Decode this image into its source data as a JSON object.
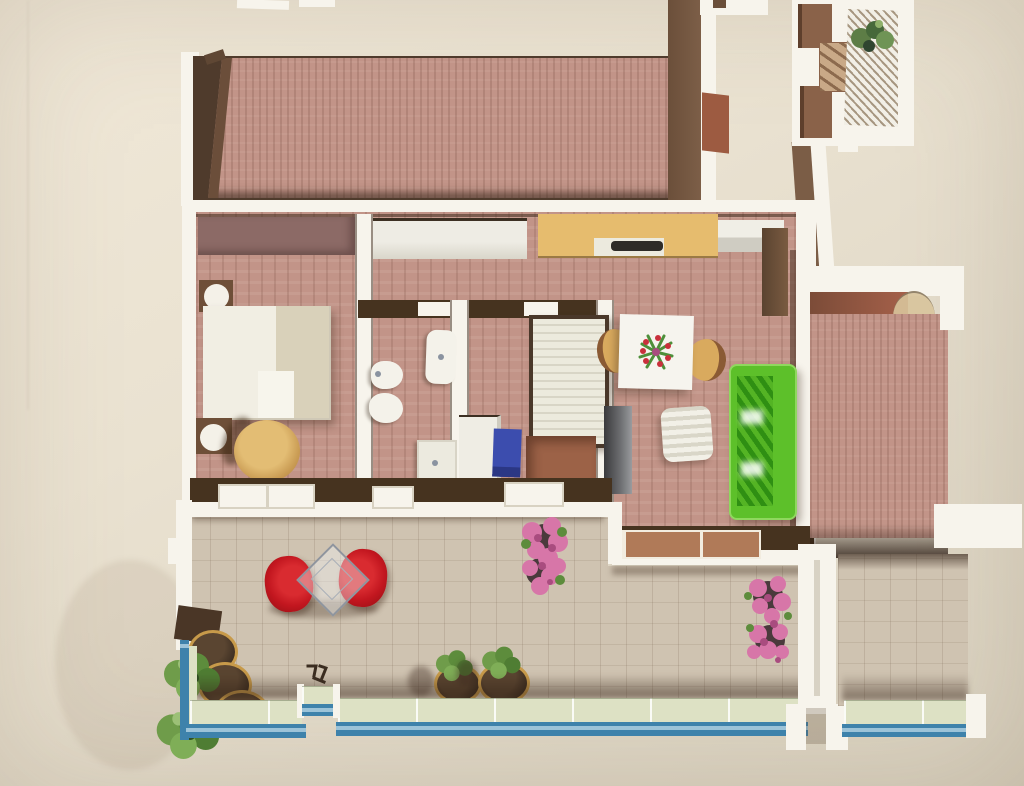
{
  "meta": {
    "type": "3d-floor-plan-rendering-photo",
    "visible_text": "",
    "width_px": 1024,
    "height_px": 786
  },
  "colors": {
    "wall_white": "#f7f4ec",
    "wall_dark": "#46331f",
    "wall_brown": "#7b5d46",
    "wall_red": "#a5604a",
    "parquet": "#c29488",
    "parquet_shadow": "#3a2b20",
    "terrace_tile": "#cfc3b1",
    "terrace_shadow": "#4a3a30",
    "mauve_wardrobe": "#8c6a66",
    "closet_white": "#eeece4",
    "counter_yellow": "#e6bc6e",
    "cooktop_dark": "#2e2c28",
    "bed_white": "#f1eee3",
    "bed_blanket": "#d9d1ba",
    "fixture_white": "#f4f2ea",
    "sofa_green": "#5dc02a",
    "sofa_green_dark": "#2f8f13",
    "chair_red": "#c2161f",
    "chair_tan": "#d9aa5e",
    "chair_blue": "#3c4dae",
    "dresser_brown": "#9c6247",
    "table_white": "#f6f4ee",
    "glass_blue": "#3e82ab",
    "railing_glass": "#dde1c4",
    "plant_green": "#5f8f3e",
    "plant_green_dark": "#3f6b2a",
    "flower_pink": "#d776a8",
    "flower_pink_deep": "#a94c7f",
    "pot_rim": "#c79a4a",
    "wood_sill": "#b07a58"
  },
  "scene": {
    "rooms": [
      "upper-room",
      "bedroom",
      "bathroom",
      "second-bedroom",
      "hallway",
      "kitchen",
      "living-dining-room",
      "main-terrace",
      "side-terrace",
      "side-room",
      "balcony"
    ],
    "furniture": [
      "double-bed",
      "bedside-lamp",
      "round-armchair",
      "wardrobe",
      "built-in-closet",
      "kitchen-counter",
      "cooktop",
      "washbasin",
      "bidet",
      "toilet",
      "bathtub",
      "shower-tray",
      "single-bed",
      "second-wardrobe",
      "washer",
      "dresser",
      "tv-cabinet",
      "dining-table",
      "flower-centerpiece",
      "dining-chair",
      "green-sofa",
      "white-armchair",
      "red-lounge-chair",
      "glass-diamond-table",
      "flower-bush",
      "planter",
      "glass-railing",
      "balcony-plant",
      "tall-cabinet"
    ]
  }
}
